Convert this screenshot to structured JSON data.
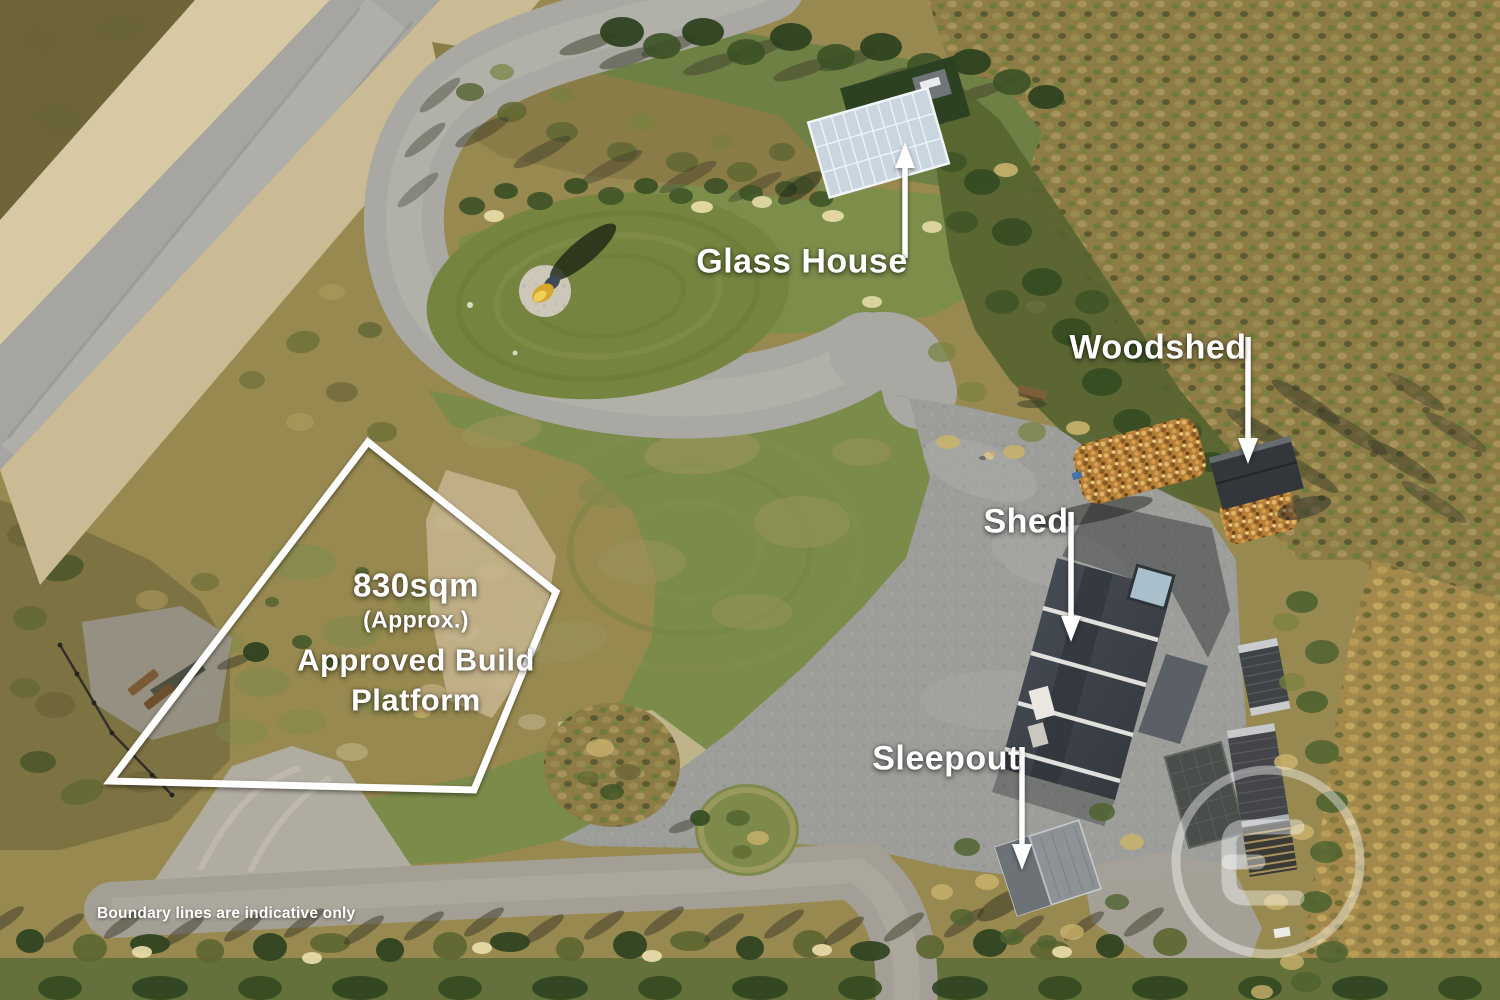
{
  "image": {
    "type": "aerial-property-marketing-photo",
    "labels": {
      "glass_house": "Glass House",
      "woodshed": "Woodshed",
      "shed": "Shed",
      "sleepout": "Sleepout"
    },
    "build_platform": {
      "area": "830sqm",
      "approx": "(Approx.)",
      "line1": "Approved Build",
      "line2": "Platform"
    },
    "disclaimer": "Boundary lines are indicative only",
    "watermark": "circular-agency-logo-watermark",
    "colors": {
      "annotation_text": "#ffffff",
      "boundary_line": "#ffffff",
      "arrow": "#ffffff",
      "lawn_green": "#7b8b49",
      "dry_field_tan": "#97894f",
      "gravel_gray": "#a6a5a1",
      "shed_roof_gray": "#3c424a",
      "scrub_olive": "#8d7c46",
      "firewood_orange": "#b5813a"
    }
  }
}
